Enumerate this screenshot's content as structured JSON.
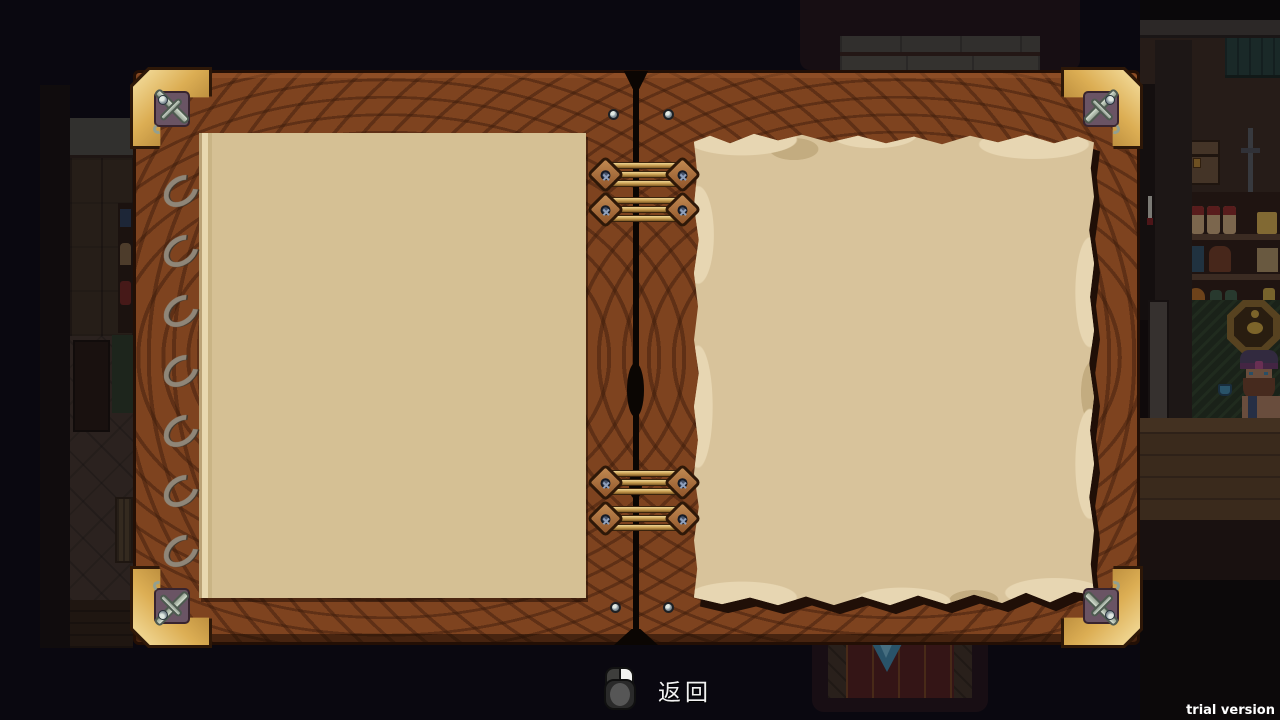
{
  "screen": {
    "width": 1280,
    "height": 720,
    "kind": "game-journal-overlay"
  },
  "book": {
    "left_page": {
      "content": ""
    },
    "right_page": {
      "content": ""
    },
    "decorations": [
      "corner-sword-emblem",
      "spiral-rings",
      "brass-hinges",
      "screws"
    ]
  },
  "footer": {
    "back_hint_icon": "mouse-right-click-icon",
    "back_hint_label": "返回"
  },
  "watermark": {
    "label": "trial version"
  },
  "colors": {
    "background": "#0b0912",
    "wood_cover": "#7e431f",
    "wood_grain": "#3a1a0a",
    "gold_corner": "#dcae54",
    "plate_purple": "#6a5464",
    "silver_emblem": "#93a090",
    "left_page": "#d5c094",
    "parchment": "#d8c39b",
    "parchment_light": "#e7d6b2",
    "brass_band": "#c49a4e",
    "hint_text": "#f2f2f2",
    "watermark_text": "#ffffff",
    "gem_blue": "#3f86a5",
    "sign_gold": "#c8a23c"
  }
}
